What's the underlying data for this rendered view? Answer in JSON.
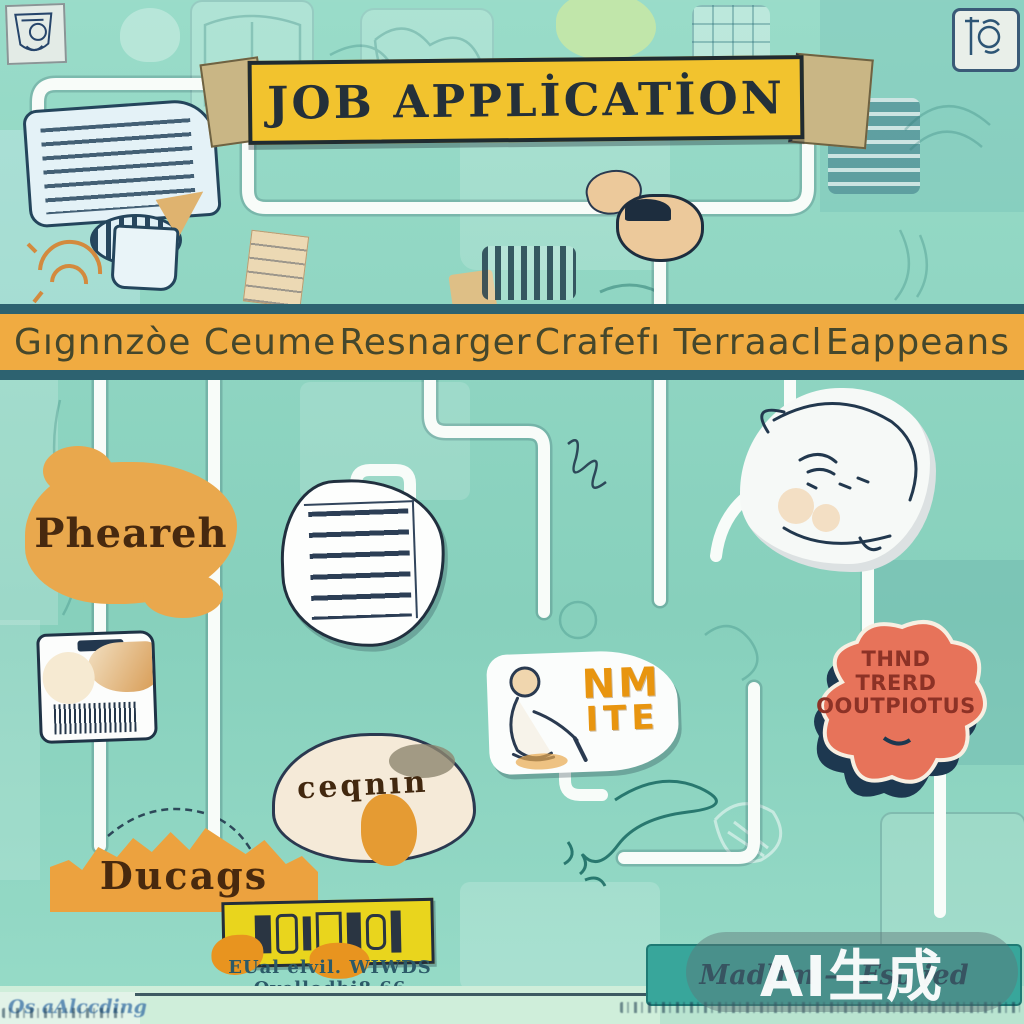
{
  "banner": {
    "title": "JOB APPLİCATİON"
  },
  "phase_band": {
    "items": [
      {
        "label": "Gıgnnzòe Ceume"
      },
      {
        "label": "Resnarger"
      },
      {
        "label": "Crafefı Terraacl"
      },
      {
        "label": "Eappeans"
      }
    ]
  },
  "nodes": {
    "research_blob": {
      "label": "Pheareh"
    },
    "outputs_splat": {
      "line1": "THND",
      "line2": "TRERD",
      "line3": "OOUTPIOTUS"
    },
    "interview_card": {
      "line1": "NM",
      "line2": "ITE"
    },
    "curled_figure": {
      "label": "ceqnın"
    },
    "mound": {
      "label": "Ducags"
    }
  },
  "footer": {
    "caption": "EUal elvil. WIWDS Qvellodhi8 66",
    "corner_text": "Os aAlccding",
    "right_box_text": "Madlim — Fso ied",
    "watermark": "AI生成"
  },
  "colors": {
    "background": "#8ed8c3",
    "band_orange": "#f0ab41",
    "band_border": "#2d6270",
    "banner_yellow": "#f2c32e",
    "splat_coral": "#e7735a",
    "splat_shadow": "#1d3850",
    "mound_orange": "#eca23f",
    "track_white": "#f8fcf9",
    "ink_navy": "#22384e",
    "teal_box": "#38a69b"
  },
  "icons": [
    "top-left-badge-icon",
    "top-right-badge-icon",
    "typewriter-icon",
    "document-icon",
    "barcode-card-icon",
    "cat-figure-icon",
    "peeking-head-icon",
    "gear-scribble-icon",
    "speaker-grill-icon",
    "graffiti-bar",
    "ai-watermark-badge"
  ]
}
